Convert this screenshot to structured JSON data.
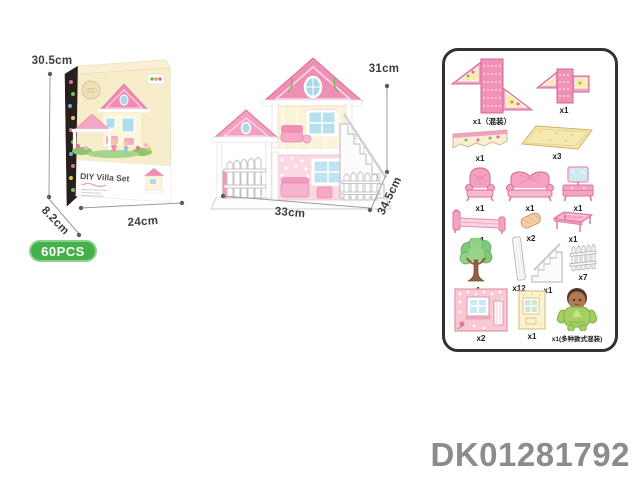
{
  "box": {
    "title": "DIY Villa Set",
    "height_label": "30.5cm",
    "depth_label": "8.2cm",
    "width_label": "24cm"
  },
  "badge": {
    "text": "60PCS",
    "color": "#45b14b"
  },
  "house": {
    "height_label": "31cm",
    "width_label": "33cm",
    "depth_label": "34.5cm"
  },
  "parts": {
    "items": [
      {
        "name": "roof-panel-large",
        "qty": "x1（混装）"
      },
      {
        "name": "roof-panel-small",
        "qty": "x1"
      },
      {
        "name": "eave-panel",
        "qty": "x1"
      },
      {
        "name": "floor-panel",
        "qty": "x3"
      },
      {
        "name": "armchair",
        "qty": "x1"
      },
      {
        "name": "sofa",
        "qty": "x1"
      },
      {
        "name": "dresser-mirror",
        "qty": "x1"
      },
      {
        "name": "bed",
        "qty": "x1"
      },
      {
        "name": "pillow-roll",
        "qty": "x2"
      },
      {
        "name": "coffee-table",
        "qty": "x1"
      },
      {
        "name": "tree",
        "qty": "x1"
      },
      {
        "name": "pillar",
        "qty": "x12"
      },
      {
        "name": "stairs",
        "qty": "x1"
      },
      {
        "name": "fence",
        "qty": "x7"
      },
      {
        "name": "wall-pink-window",
        "qty": "x2"
      },
      {
        "name": "wall-cream-window",
        "qty": "x1"
      },
      {
        "name": "doll",
        "qty": "x1(多种款式混装)"
      }
    ]
  },
  "product_code": "DK01281792"
}
